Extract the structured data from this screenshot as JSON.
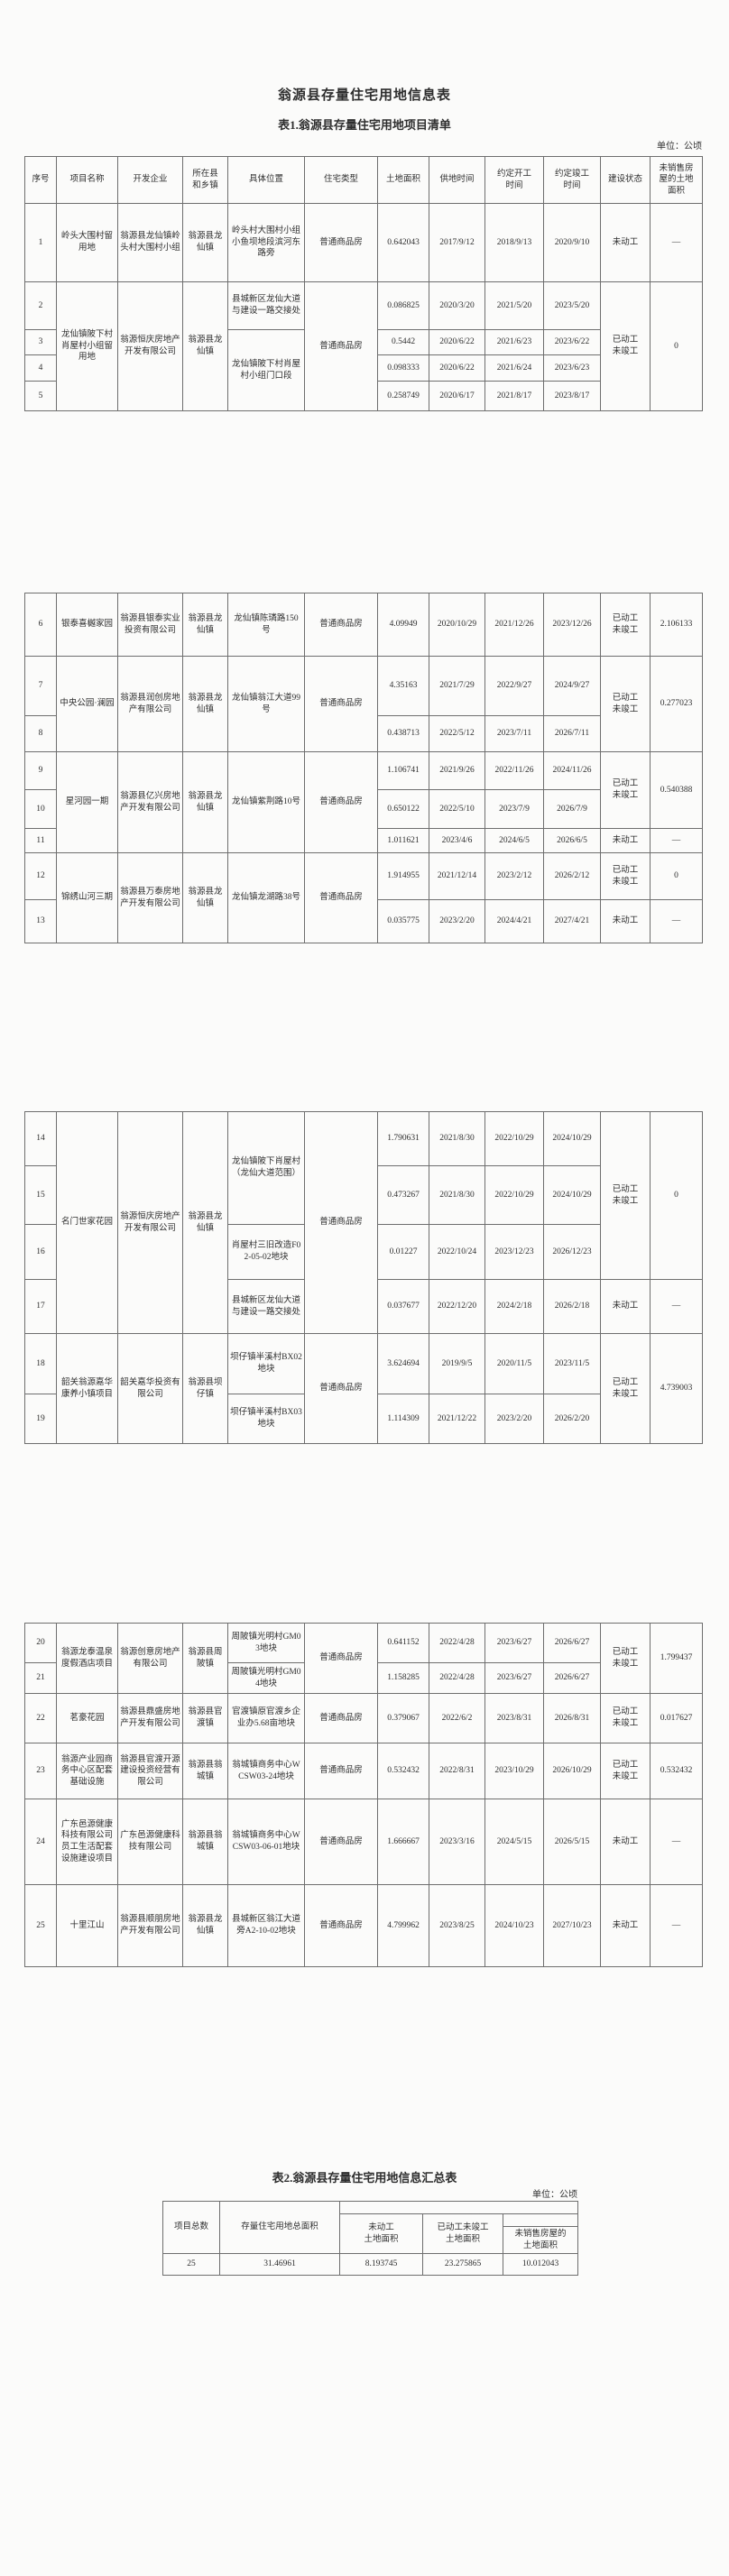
{
  "doc": {
    "main_title": "翁源县存量住宅用地信息表"
  },
  "table1": {
    "subtitle": "表1.翁源县存量住宅用地项目清单",
    "unit_label": "单位：公顷",
    "headers": {
      "no": "序号",
      "name": "项目名称",
      "dev": "开发企业",
      "town": "所在县\n和乡镇",
      "loc": "具体位置",
      "type": "住宅类型",
      "area": "土地面积",
      "supply": "供地时间",
      "start": "约定开工\n时间",
      "finish": "约定竣工\n时间",
      "status": "建设状态",
      "unsold": "未销售房\n屋的土地\n面积"
    },
    "rows": [
      {
        "no": "1",
        "name": "岭头大围村留用地",
        "dev": "翁源县龙仙镇岭头村大围村小组",
        "town": "翁源县龙仙镇",
        "loc": "岭头村大围村小组小鱼坝地段滨河东路旁",
        "type": "普通商品房",
        "area": "0.642043",
        "supply": "2017/9/12",
        "start": "2018/9/13",
        "finish": "2020/9/10",
        "status": "未动工",
        "unsold": "—"
      },
      {
        "no": "2",
        "name": "龙仙镇陂下村肖屋村小组留用地",
        "dev": "翁源恒庆房地产开发有限公司",
        "town": "翁源县龙仙镇",
        "loc": "县城新区龙仙大道与建设一路交接处",
        "type": "普通商品房",
        "area": "0.086825",
        "supply": "2020/3/20",
        "start": "2021/5/20",
        "finish": "2023/5/20",
        "status": "已动工\n未竣工",
        "unsold": "0"
      },
      {
        "no": "3",
        "loc": "龙仙镇陂下村肖屋村小组门口段",
        "area": "0.5442",
        "supply": "2020/6/22",
        "start": "2021/6/23",
        "finish": "2023/6/22"
      },
      {
        "no": "4",
        "area": "0.098333",
        "supply": "2020/6/22",
        "start": "2021/6/24",
        "finish": "2023/6/23"
      },
      {
        "no": "5",
        "area": "0.258749",
        "supply": "2020/6/17",
        "start": "2021/8/17",
        "finish": "2023/8/17"
      },
      {
        "no": "6",
        "name": "银泰喜樾家园",
        "dev": "翁源县银泰实业投资有限公司",
        "town": "翁源县龙仙镇",
        "loc": "龙仙镇陈璘路150号",
        "type": "普通商品房",
        "area": "4.09949",
        "supply": "2020/10/29",
        "start": "2021/12/26",
        "finish": "2023/12/26",
        "status": "已动工\n未竣工",
        "unsold": "2.106133"
      },
      {
        "no": "7",
        "name": "中央公园·澜园",
        "dev": "翁源县润创房地产有限公司",
        "town": "翁源县龙仙镇",
        "loc": "龙仙镇翁江大道99号",
        "type": "普通商品房",
        "area": "4.35163",
        "supply": "2021/7/29",
        "start": "2022/9/27",
        "finish": "2024/9/27",
        "status": "已动工\n未竣工",
        "unsold": "0.277023"
      },
      {
        "no": "8",
        "area": "0.438713",
        "supply": "2022/5/12",
        "start": "2023/7/11",
        "finish": "2026/7/11"
      },
      {
        "no": "9",
        "name": "星河园一期",
        "dev": "翁源县亿兴房地产开发有限公司",
        "town": "翁源县龙仙镇",
        "loc": "龙仙镇紫荆路10号",
        "type": "普通商品房",
        "area": "1.106741",
        "supply": "2021/9/26",
        "start": "2022/11/26",
        "finish": "2024/11/26",
        "status": "已动工\n未竣工",
        "unsold": "0.540388"
      },
      {
        "no": "10",
        "area": "0.650122",
        "supply": "2022/5/10",
        "start": "2023/7/9",
        "finish": "2026/7/9"
      },
      {
        "no": "11",
        "area": "1.011621",
        "supply": "2023/4/6",
        "start": "2024/6/5",
        "finish": "2026/6/5",
        "status": "未动工",
        "unsold": "—"
      },
      {
        "no": "12",
        "name": "锦绣山河三期",
        "dev": "翁源县万泰房地产开发有限公司",
        "town": "翁源县龙仙镇",
        "loc": "龙仙镇龙湖路38号",
        "type": "普通商品房",
        "area": "1.914955",
        "supply": "2021/12/14",
        "start": "2023/2/12",
        "finish": "2026/2/12",
        "status": "已动工\n未竣工",
        "unsold": "0"
      },
      {
        "no": "13",
        "area": "0.035775",
        "supply": "2023/2/20",
        "start": "2024/4/21",
        "finish": "2027/4/21",
        "status": "未动工",
        "unsold": "—"
      },
      {
        "no": "14",
        "name": "名门世家花园",
        "dev": "翁源恒庆房地产开发有限公司",
        "town": "翁源县龙仙镇",
        "loc": "龙仙镇陂下肖屋村（龙仙大道范围）",
        "type": "普通商品房",
        "area": "1.790631",
        "supply": "2021/8/30",
        "start": "2022/10/29",
        "finish": "2024/10/29",
        "status": "已动工\n未竣工",
        "unsold": "0"
      },
      {
        "no": "15",
        "area": "0.473267",
        "supply": "2021/8/30",
        "start": "2022/10/29",
        "finish": "2024/10/29"
      },
      {
        "no": "16",
        "loc": "肖屋村三旧改造F02-05-02地块",
        "area": "0.01227",
        "supply": "2022/10/24",
        "start": "2023/12/23",
        "finish": "2026/12/23"
      },
      {
        "no": "17",
        "loc": "县城新区龙仙大道与建设一路交接处",
        "area": "0.037677",
        "supply": "2022/12/20",
        "start": "2024/2/18",
        "finish": "2026/2/18",
        "status": "未动工",
        "unsold": "—"
      },
      {
        "no": "18",
        "name": "韶关翁源嘉华康养小镇项目",
        "dev": "韶关嘉华投资有限公司",
        "town": "翁源县坝仔镇",
        "loc": "坝仔镇半溪村BX02地块",
        "type": "普通商品房",
        "area": "3.624694",
        "supply": "2019/9/5",
        "start": "2020/11/5",
        "finish": "2023/11/5",
        "status": "已动工\n未竣工",
        "unsold": "4.739003"
      },
      {
        "no": "19",
        "loc": "坝仔镇半溪村BX03地块",
        "area": "1.114309",
        "supply": "2021/12/22",
        "start": "2023/2/20",
        "finish": "2026/2/20"
      },
      {
        "no": "20",
        "name": "翁源龙泰温泉度假酒店项目",
        "dev": "翁源创意房地产有限公司",
        "town": "翁源县周陂镇",
        "loc": "周陂镇光明村GM03地块",
        "type": "普通商品房",
        "area": "0.641152",
        "supply": "2022/4/28",
        "start": "2023/6/27",
        "finish": "2026/6/27",
        "status": "已动工\n未竣工",
        "unsold": "1.799437"
      },
      {
        "no": "21",
        "loc": "周陂镇光明村GM04地块",
        "area": "1.158285",
        "supply": "2022/4/28",
        "start": "2023/6/27",
        "finish": "2026/6/27"
      },
      {
        "no": "22",
        "name": "茗豪花园",
        "dev": "翁源县鼎盛房地产开发有限公司",
        "town": "翁源县官渡镇",
        "loc": "官渡镇原官渡乡企业办5.68亩地块",
        "type": "普通商品房",
        "area": "0.379067",
        "supply": "2022/6/2",
        "start": "2023/8/31",
        "finish": "2026/8/31",
        "status": "已动工\n未竣工",
        "unsold": "0.017627"
      },
      {
        "no": "23",
        "name": "翁源产业园商务中心区配套基础设施",
        "dev": "翁源县官渡开源建设投资经营有限公司",
        "town": "翁源县翁城镇",
        "loc": "翁城镇商务中心WCSW03-24地块",
        "type": "普通商品房",
        "area": "0.532432",
        "supply": "2022/8/31",
        "start": "2023/10/29",
        "finish": "2026/10/29",
        "status": "已动工\n未竣工",
        "unsold": "0.532432"
      },
      {
        "no": "24",
        "name": "广东邑源健康科技有限公司员工生活配套设施建设项目",
        "dev": "广东邑源健康科技有限公司",
        "town": "翁源县翁城镇",
        "loc": "翁城镇商务中心WCSW03-06-01地块",
        "type": "普通商品房",
        "area": "1.666667",
        "supply": "2023/3/16",
        "start": "2024/5/15",
        "finish": "2026/5/15",
        "status": "未动工",
        "unsold": "—"
      },
      {
        "no": "25",
        "name": "十里江山",
        "dev": "翁源县顺朋房地产开发有限公司",
        "town": "翁源县龙仙镇",
        "loc": "县城新区翁江大道旁A2-10-02地块",
        "type": "普通商品房",
        "area": "4.799962",
        "supply": "2023/8/25",
        "start": "2024/10/23",
        "finish": "2027/10/23",
        "status": "未动工",
        "unsold": "—"
      }
    ]
  },
  "table2": {
    "subtitle": "表2.翁源县存量住宅用地信息汇总表",
    "unit_label": "单位：公顷",
    "headers": {
      "total_projects": "项目总数",
      "total_area": "存量住宅用地总面积",
      "not_started_area": "未动工\n土地面积",
      "started_unfinished_area": "已动工未竣工\n土地面积",
      "unsold_area": "未销售房屋的\n土地面积"
    },
    "summary": {
      "total_projects": "25",
      "total_area": "31.46961",
      "not_started_area": "8.193745",
      "started_unfinished_area": "23.275865",
      "unsold_area": "10.012043"
    }
  }
}
